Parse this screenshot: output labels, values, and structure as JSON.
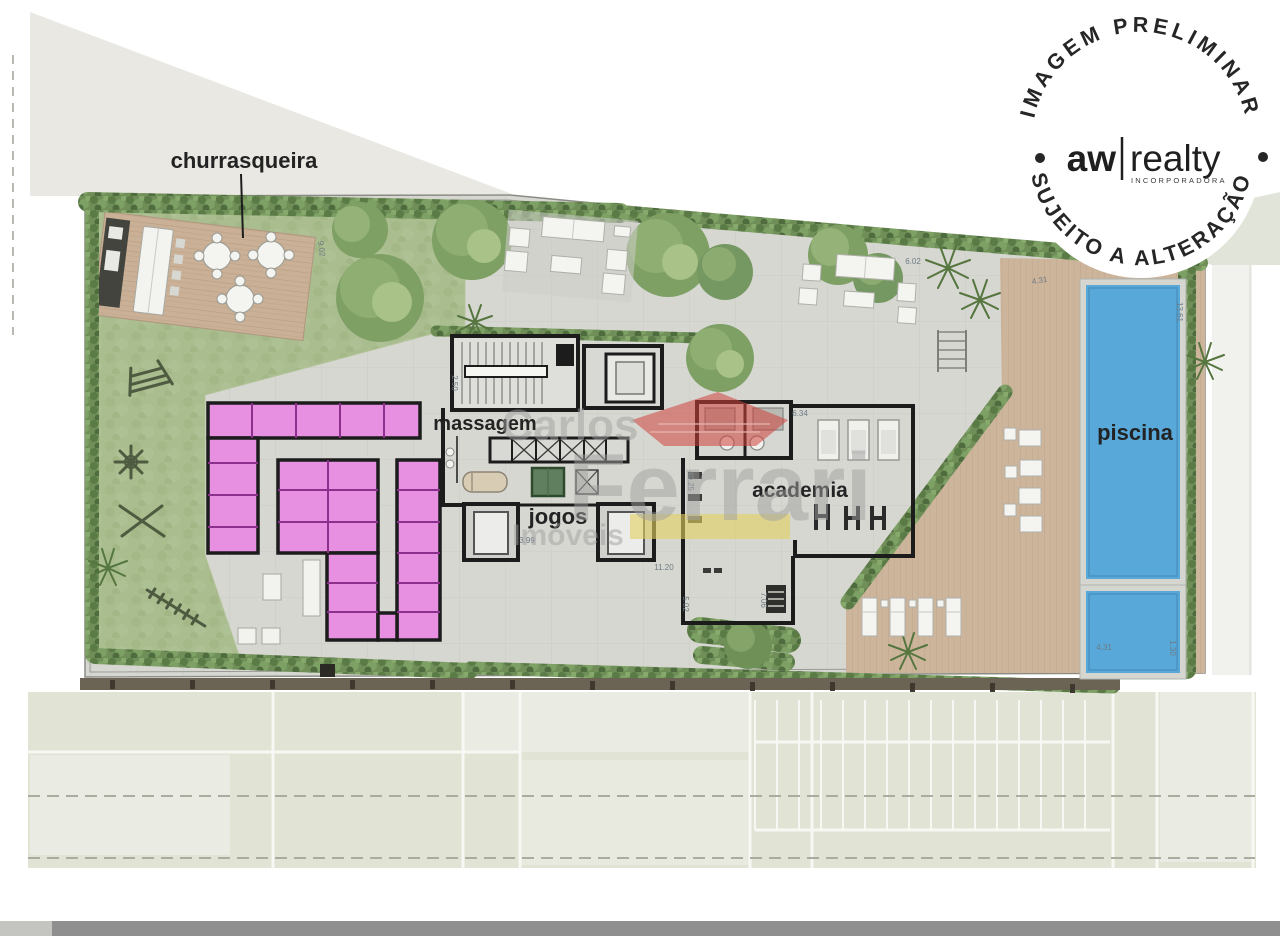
{
  "labels": {
    "churrasqueira": "churrasqueira",
    "massagem": "massagem",
    "jogos": "jogos",
    "academia": "academia",
    "piscina": "piscina"
  },
  "stamp": {
    "top_arc": "IMAGEM PRELIMINAR",
    "brand_left": "aw",
    "brand_right": "realty",
    "brand_sub": "INCORPORADORA",
    "bottom_arc": "SUJEITO A ALTERAÇÃO"
  },
  "watermark": {
    "line1": "Carlos",
    "line2": "Ferrari",
    "line3": "Imóveis"
  },
  "dimensions": [
    {
      "value": "9.02"
    },
    {
      "value": "2.50"
    },
    {
      "value": "6.02"
    },
    {
      "value": "4.31"
    },
    {
      "value": "13.61"
    },
    {
      "value": "4.31"
    },
    {
      "value": "1.30"
    },
    {
      "value": "11.20"
    },
    {
      "value": "5.02"
    },
    {
      "value": "7.06"
    },
    {
      "value": "6.34"
    },
    {
      "value": "40.25"
    },
    {
      "value": "3.99"
    }
  ],
  "colors": {
    "pool_water": "#58a9d9",
    "storage_pink": "#e78fe0",
    "lawn_green": "#a9bd8e",
    "deck_wood": "#c9b096",
    "hedge_green": "#6f8e58",
    "wall_black": "#1c1c1c",
    "watermark_red": "#d0413b",
    "watermark_yellow": "#e3d15f"
  }
}
